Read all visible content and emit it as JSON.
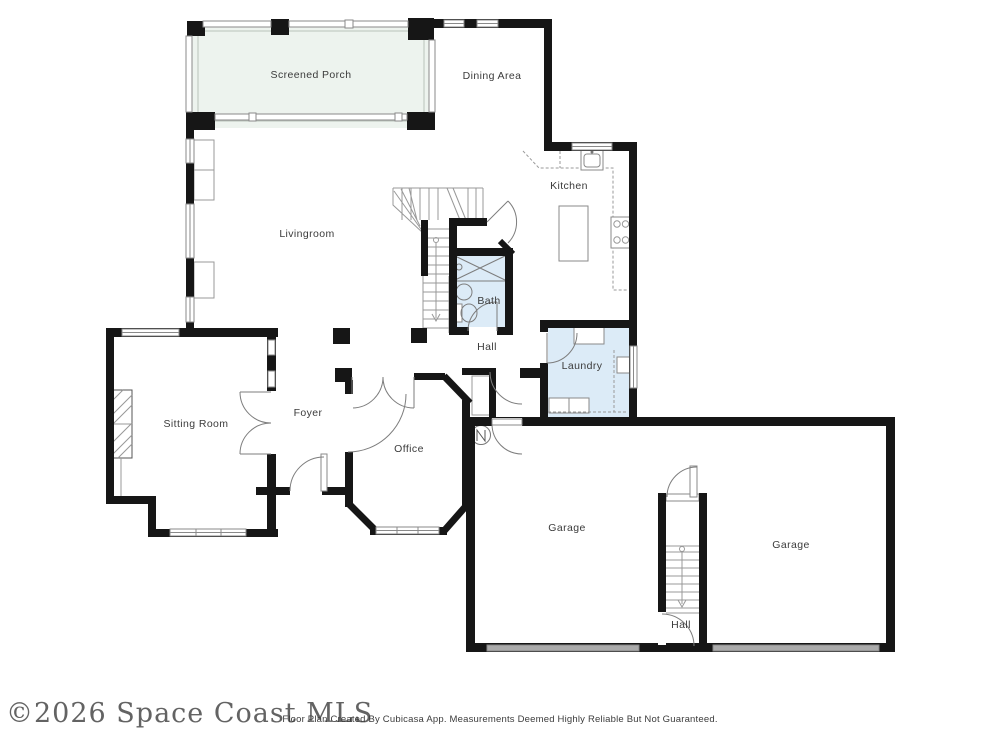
{
  "floorplan": {
    "rooms": [
      {
        "id": "screened-porch",
        "label": "Screened Porch"
      },
      {
        "id": "dining-area",
        "label": "Dining Area"
      },
      {
        "id": "kitchen",
        "label": "Kitchen"
      },
      {
        "id": "livingroom",
        "label": "Livingroom"
      },
      {
        "id": "bath",
        "label": "Bath"
      },
      {
        "id": "hall",
        "label": "Hall"
      },
      {
        "id": "laundry",
        "label": "Laundry"
      },
      {
        "id": "sitting-room",
        "label": "Sitting Room"
      },
      {
        "id": "foyer",
        "label": "Foyer"
      },
      {
        "id": "office",
        "label": "Office"
      },
      {
        "id": "garage-left",
        "label": "Garage"
      },
      {
        "id": "garage-right",
        "label": "Garage"
      },
      {
        "id": "garage-hall",
        "label": "Hall"
      }
    ],
    "colors": {
      "wall": "#161616",
      "porch_fill": "#edf3ee",
      "wet_room_fill": "#dcebf7",
      "garage_door": "#ababab",
      "label_text": "#3b3b3b"
    }
  },
  "footer": {
    "watermark": "©2026 Space Coast MLS",
    "disclaimer": "Floor Plan Created By Cubicasa App. Measurements Deemed Highly Reliable But Not Guaranteed."
  }
}
